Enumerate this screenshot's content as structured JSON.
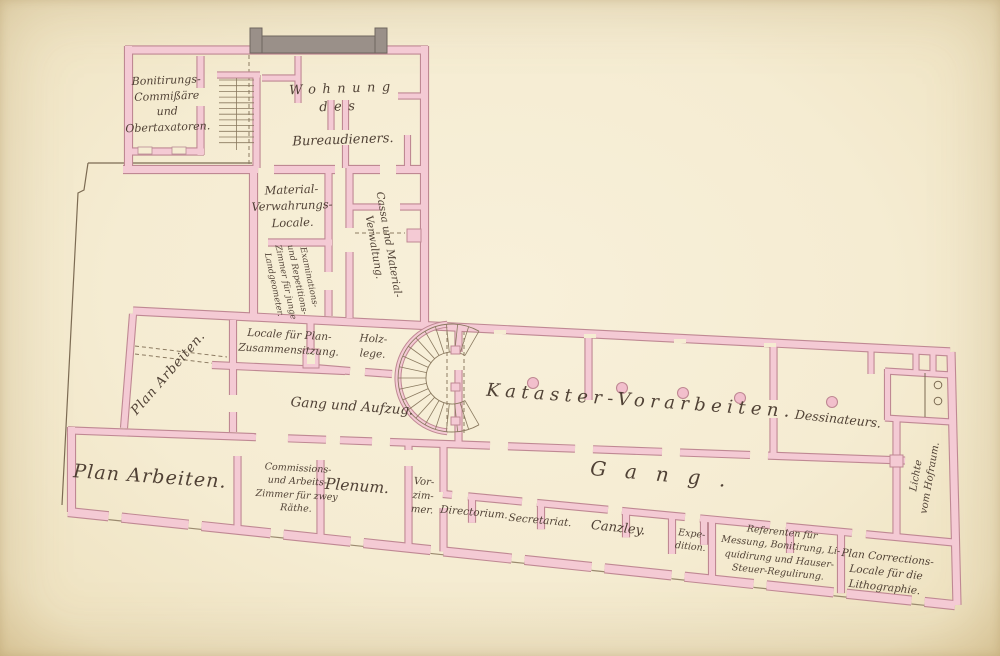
{
  "labels": {
    "bonitirungs": "Bonitirungs-\nCommißäre\nund\nObertaxatoren.",
    "wohnung_head": "Wohnung\ndes",
    "wohnung_name": "Bureaudieners.",
    "material": "Material-\nVerwahrungs-\nLocale.",
    "cassa": "Cassa und Material-\nVerwaltung.",
    "examinations": "Examinations-\nund Repetitions-\nZimmer für junge\nLandgeometer.",
    "locale_plan": "Locale für Plan-\nZusammensitzung.",
    "holzlege": "Holz-\nlege.",
    "plan_arbeiten_diag": "Plan Arbeiten.",
    "gang_aufzug": "Gang und Aufzug.",
    "kataster": "Kataster-Vorarbeiten.",
    "dessinateurs": "Dessinateurs.",
    "plan_arbeiten_big": "Plan Arbeiten.",
    "commissions": "Commissions-\nund Arbeits-\nZimmer für zwey\nRäthe.",
    "plenum": "Plenum.",
    "vorzimmer": "Vor-\nzim-\nmer.",
    "directorium": "Directorium.",
    "secretariat": "Secretariat.",
    "canzley": "Canzley.",
    "gang_big": "Gang.",
    "expedition": "Expe-\ndition.",
    "referenten": "Referenten für\nMessung, Bonitirung, Li-\nquidirung und Hauser-\nSteuer-Regulirung.",
    "plan_corrections": "Plan Corrections-\nLocale für die\nLithographie.",
    "lichte": "Lichte\nvom Hofraum."
  },
  "colors": {
    "paper": "#f5ecd2",
    "wall_fill": "#f4cad4",
    "wall_edge": "#bf8893",
    "column_fill": "#f2bfcc",
    "gray_masonry": "#9a9089",
    "gray_edge": "#6f665e",
    "thin_line": "#7c6b53",
    "dash_line": "#8c7b62",
    "ink": "#44352a"
  }
}
